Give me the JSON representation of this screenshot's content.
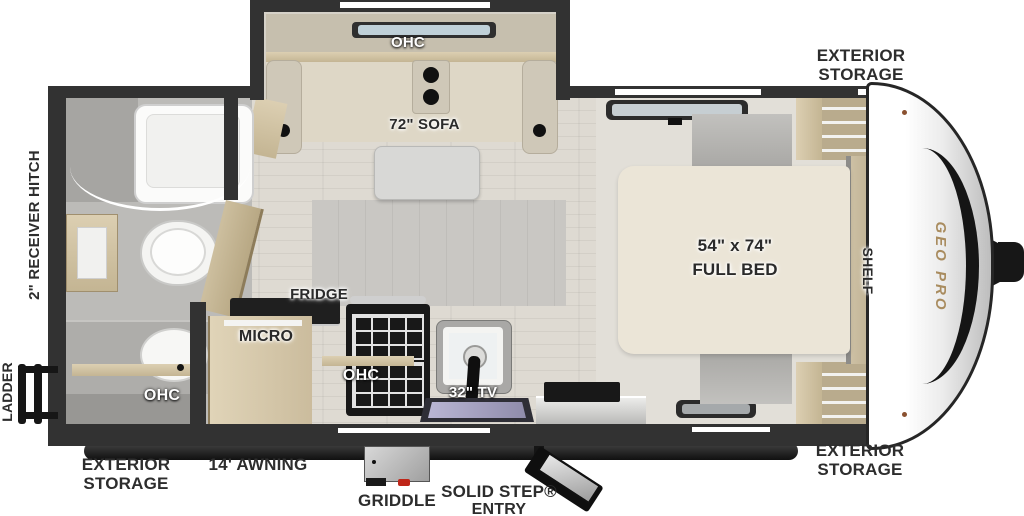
{
  "floorplan": {
    "brand_logo": "GEO PRO",
    "slideout": {
      "ohc": "OHC",
      "sofa": "72\" SOFA"
    },
    "bathroom": {
      "ohc": "OHC"
    },
    "kitchen": {
      "fridge": "FRIDGE",
      "micro": "MICRO",
      "ohc": "OHC",
      "tv": "32\" TV"
    },
    "bedroom": {
      "bed_size": "54\" x 74\"",
      "bed_type": "FULL BED",
      "shelf": "SHELF"
    },
    "exterior": {
      "storage_front": "EXTERIOR STORAGE",
      "storage_rear": "EXTERIOR STORAGE",
      "storage_door_side": "EXTERIOR STORAGE",
      "awning": "14' AWNING",
      "griddle": "GRIDDLE",
      "entry_step_line1": "SOLID STEP®",
      "entry_step_line2": "ENTRY",
      "ladder": "LADDER",
      "receiver_hitch": "2\" RECEIVER HITCH"
    }
  },
  "colors": {
    "wall": "#323232",
    "floor": "#dcd8d0",
    "wood": "#d3c6a9",
    "sofa": "#ded7c6",
    "bed": "#ebe5d7",
    "label_dark": "#2a2a2a",
    "label_white": "#ffffff",
    "logo_gold": "#a98c5f",
    "sink_basin": "#a9a6c6",
    "griddle_knob": "#bf2619"
  }
}
